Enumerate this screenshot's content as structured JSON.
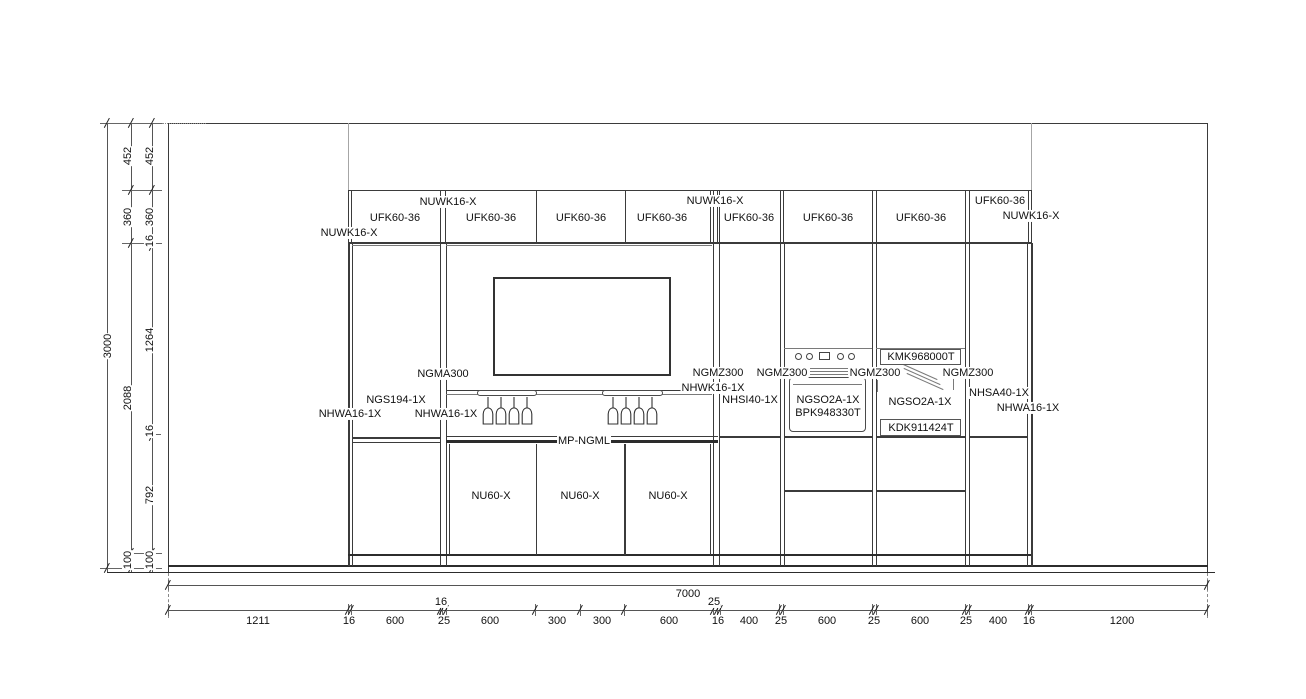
{
  "labels": {
    "wall_fillers": [
      "NUWK16-X",
      "NUWK16-X",
      "NUWK16-X",
      "NUWK16-X"
    ],
    "wall_cabinets": [
      "UFK60-36",
      "UFK60-36",
      "UFK60-36",
      "UFK60-36",
      "UFK60-36",
      "UFK60-36",
      "UFK60-36",
      "UFK60-36"
    ],
    "left_tall": {
      "back_panel": "NGMA300",
      "glass_unit": "NGS194-1X",
      "side_panel_left": "NHWA16-1X",
      "side_panel_right": "NHWA16-1X"
    },
    "niche": {
      "worktop": "MP-NGML",
      "base_units": [
        "NU60-X",
        "NU60-X",
        "NU60-X"
      ]
    },
    "right_tall": {
      "back_panels": [
        "NGMZ300",
        "NGMZ300",
        "NGMZ300",
        "NGMZ300"
      ],
      "filler": "NHWK16-1X",
      "unit_40_left": "NHSI40-1X",
      "oven_housing": "NGSO2A-1X",
      "oven_appliance": "BPK948330T",
      "top_appliance": "KMK968000T",
      "mw_housing": "NGSO2A-1X",
      "drawer_appliance": "KDK911424T",
      "unit_40_right": "NHSA40-1X",
      "side_panel_right": "NHWA16-1X"
    }
  },
  "dimensions": {
    "overall_height": "3000",
    "overall_width": "7000",
    "height_chain_outer": [
      "452",
      "360",
      "2088",
      "100"
    ],
    "height_chain_inner": [
      "452",
      "360",
      "16",
      "1264",
      "16",
      "792",
      "100"
    ],
    "width_chain": [
      "1211",
      "16",
      "600",
      "25",
      "600",
      "300",
      "300",
      "600",
      "16",
      "400",
      "25",
      "600",
      "25",
      "600",
      "25",
      "400",
      "16",
      "1200"
    ],
    "width_chain_upper": [
      "16",
      "25"
    ]
  }
}
